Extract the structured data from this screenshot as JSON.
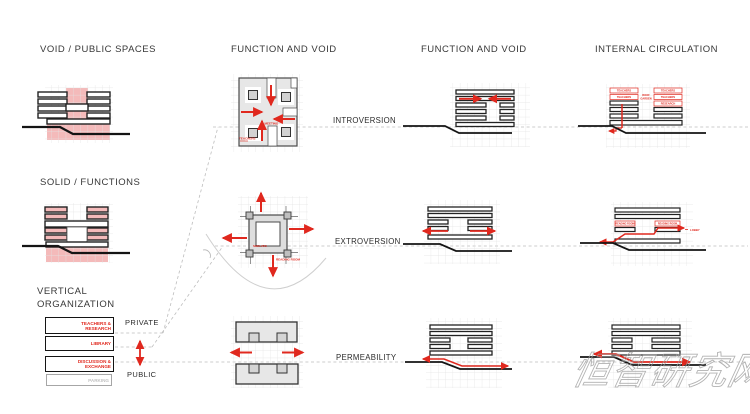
{
  "colors": {
    "red": "#e0281e",
    "pink": "#f4baba",
    "ink": "#141414",
    "guide": "#bdbdbd"
  },
  "titles": {
    "col1_void": "VOID / PUBLIC SPACES",
    "col1_solid": "SOLID / FUNCTIONS",
    "col1_vertical_1": "VERTICAL",
    "col1_vertical_2": "ORGANIZATION",
    "col2": "FUNCTION AND VOID",
    "col3": "FUNCTION AND VOID",
    "col4": "INTERNAL CIRCULATION"
  },
  "rows": {
    "row1": "INTROVERSION",
    "row2": "EXTROVERSION",
    "row3": "PERMEABILITY"
  },
  "vertical_organization": {
    "levels": [
      {
        "label": "TEACHERS & RESEARCH"
      },
      {
        "label": "LIBRARY"
      },
      {
        "label": "DISCUSSION & EXCHANGE"
      },
      {
        "label": "PARKING"
      }
    ],
    "private": "PRIVATE",
    "public": "PUBLIC"
  },
  "plans": {
    "introversion": {
      "label_a": "TEACHERS",
      "label_b": "MEETING"
    },
    "extroversion": {
      "label_a": "SHELVES",
      "label_b": "READING ROOM"
    }
  },
  "circulation": {
    "top": {
      "left_rows": [
        "TEACHERS",
        "TEACHERS"
      ],
      "right_rows": [
        "TEACHERS",
        "TEACHERS",
        "RESEARCH"
      ],
      "center_line1": "ROOF",
      "center_line2": "GARDEN"
    },
    "middle": {
      "left_label": "READING ROOM",
      "right_label": "READING ROOM",
      "exit_label": "LOBBY"
    }
  },
  "watermark": "恒智研究网"
}
